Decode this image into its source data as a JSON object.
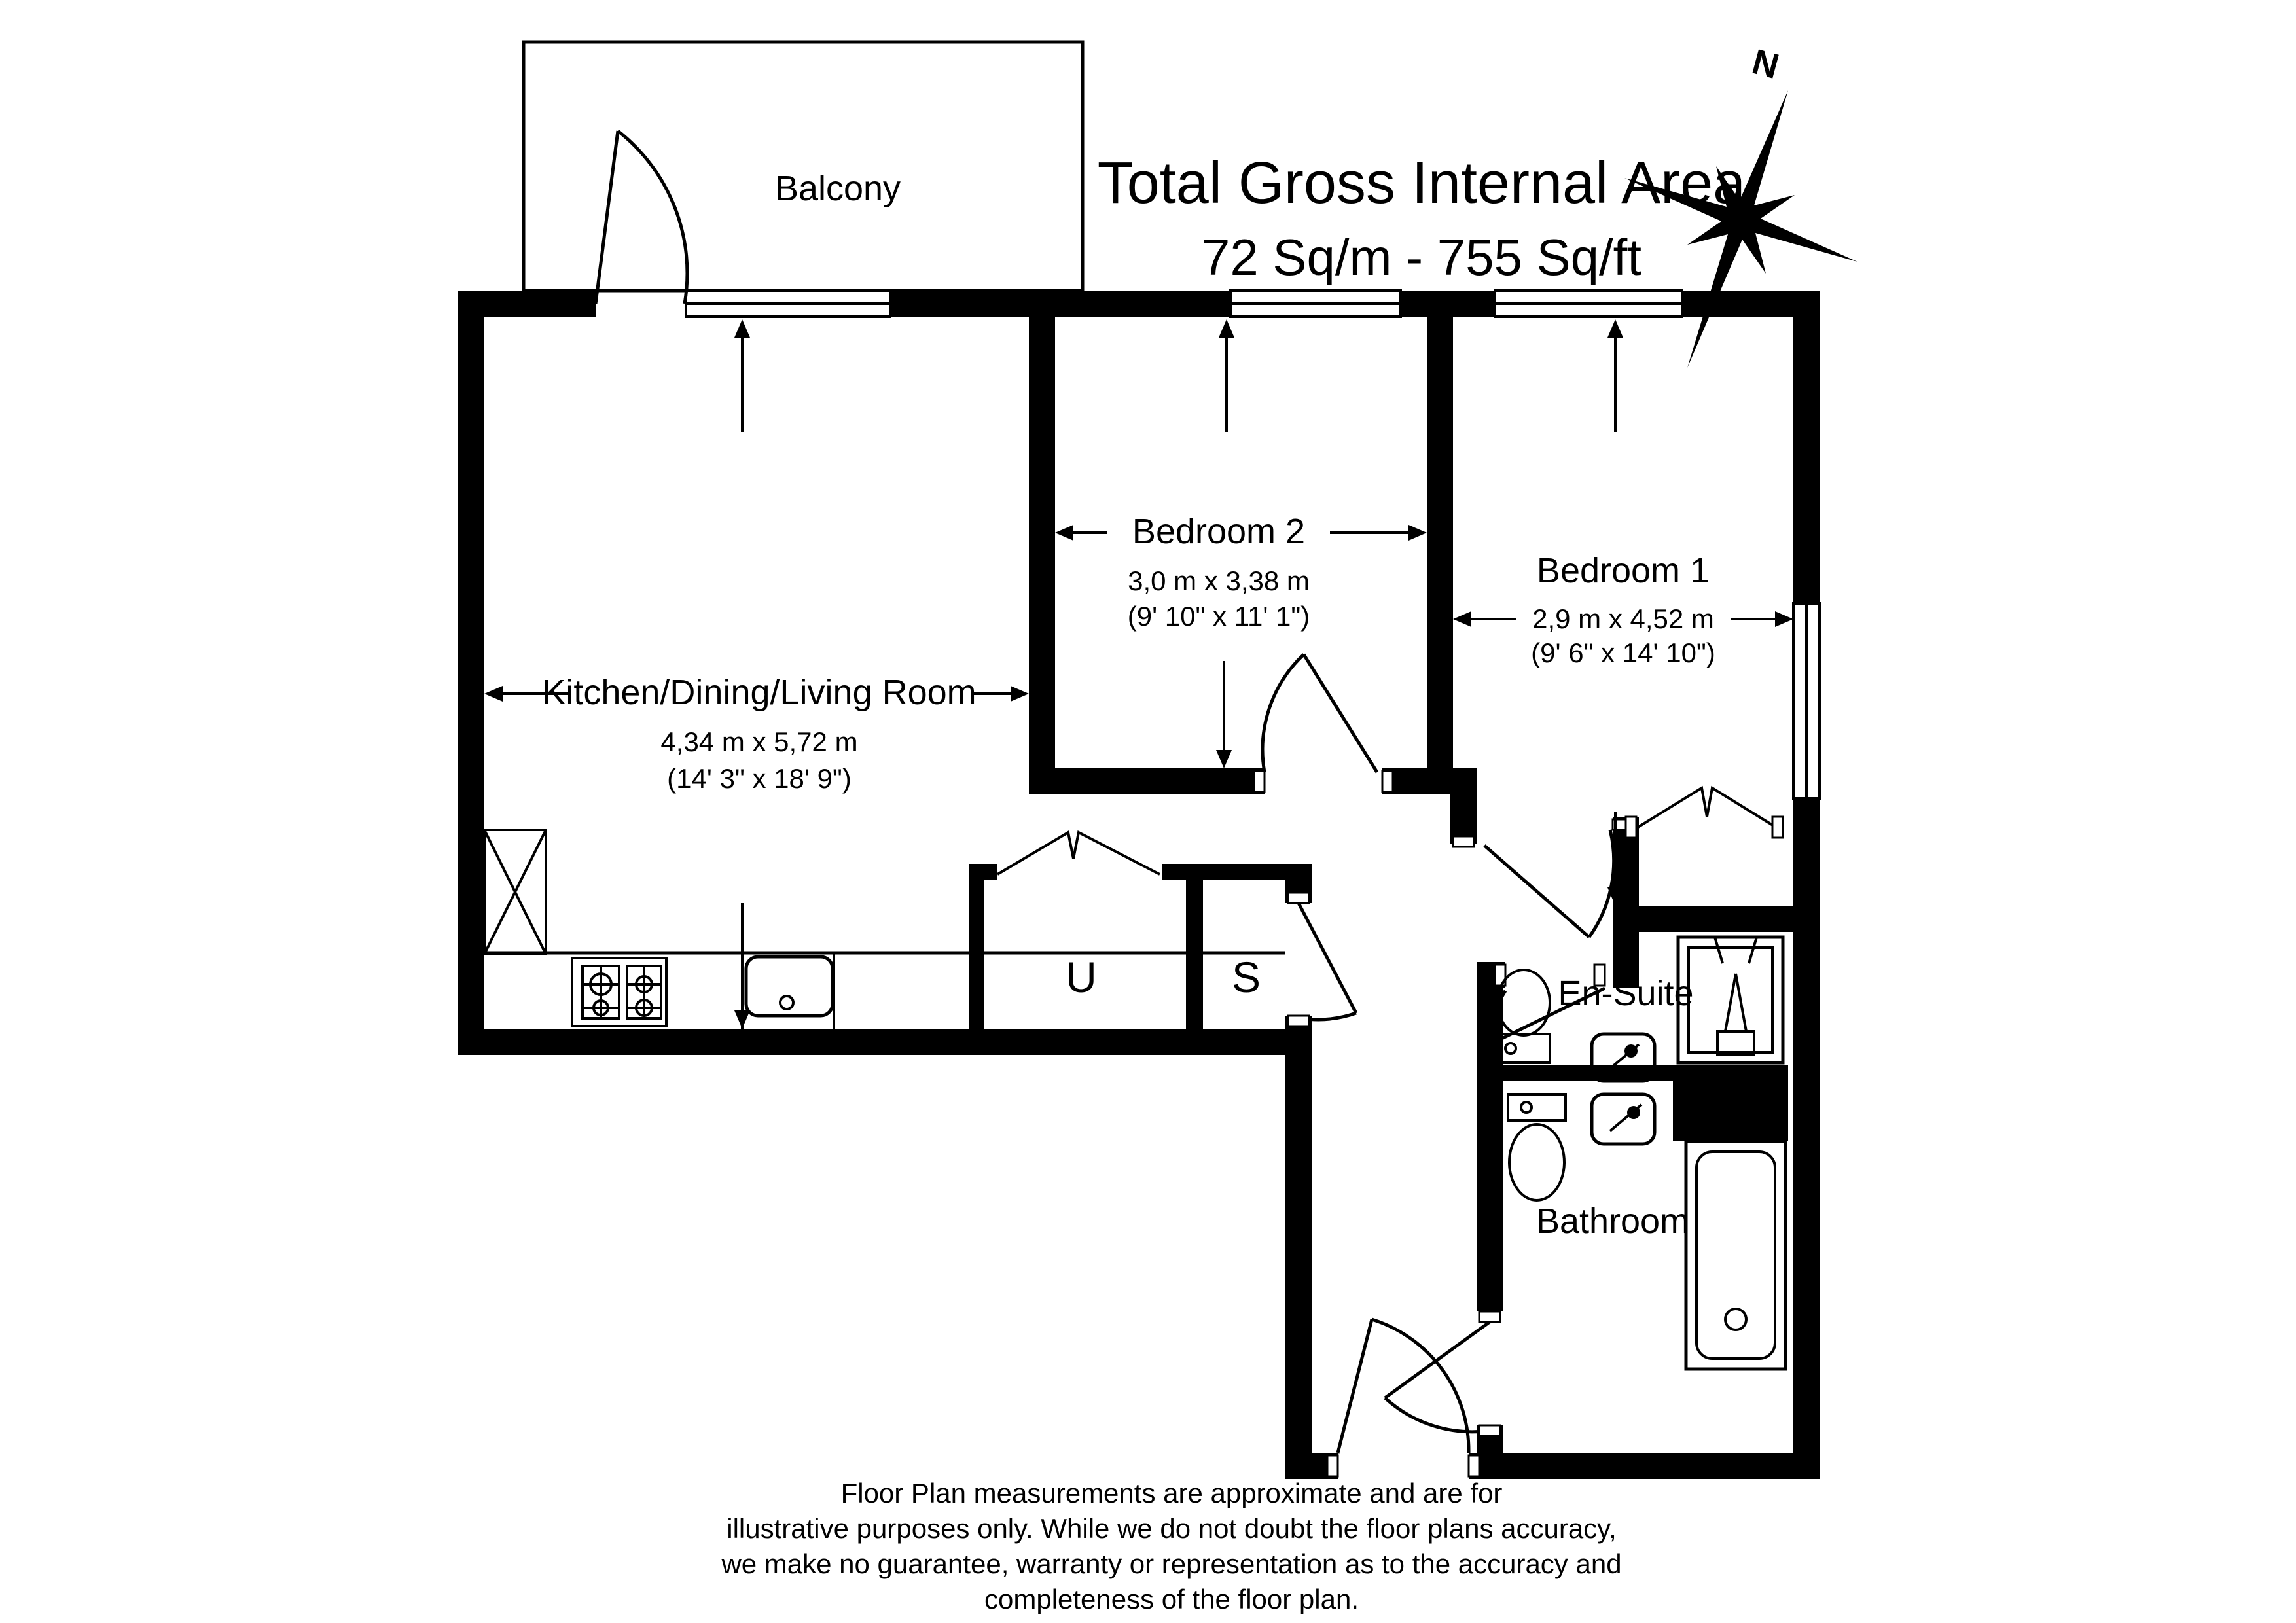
{
  "title": {
    "line1": "Total Gross Internal Area",
    "line2": "72 Sq/m - 755 Sq/ft"
  },
  "compass": {
    "north_label": "N"
  },
  "rooms": {
    "balcony": {
      "name": "Balcony"
    },
    "living": {
      "name": "Kitchen/Dining/Living Room",
      "metric": "4,34 m x 5,72 m",
      "imperial": "(14' 3\" x 18' 9\")"
    },
    "bedroom2": {
      "name": "Bedroom 2",
      "metric": "3,0 m x 3,38 m",
      "imperial": "(9' 10\" x 11' 1\")"
    },
    "bedroom1": {
      "name": "Bedroom 1",
      "metric": "2,9 m x 4,52 m",
      "imperial": "(9' 6\" x 14' 10\")"
    },
    "ensuite": {
      "name": "En-Suite"
    },
    "bathroom": {
      "name": "Bathroom"
    },
    "utility": {
      "name": "U"
    },
    "storage": {
      "name": "S"
    }
  },
  "footer": {
    "line1": "Floor Plan measurements are approximate and are for",
    "line2": "illustrative purposes only.  While we do not doubt the floor plans accuracy,",
    "line3": "we make no guarantee, warranty or representation as to the accuracy and",
    "line4": "completeness of the floor plan."
  },
  "colors": {
    "walls": "#000000",
    "background": "#ffffff"
  }
}
